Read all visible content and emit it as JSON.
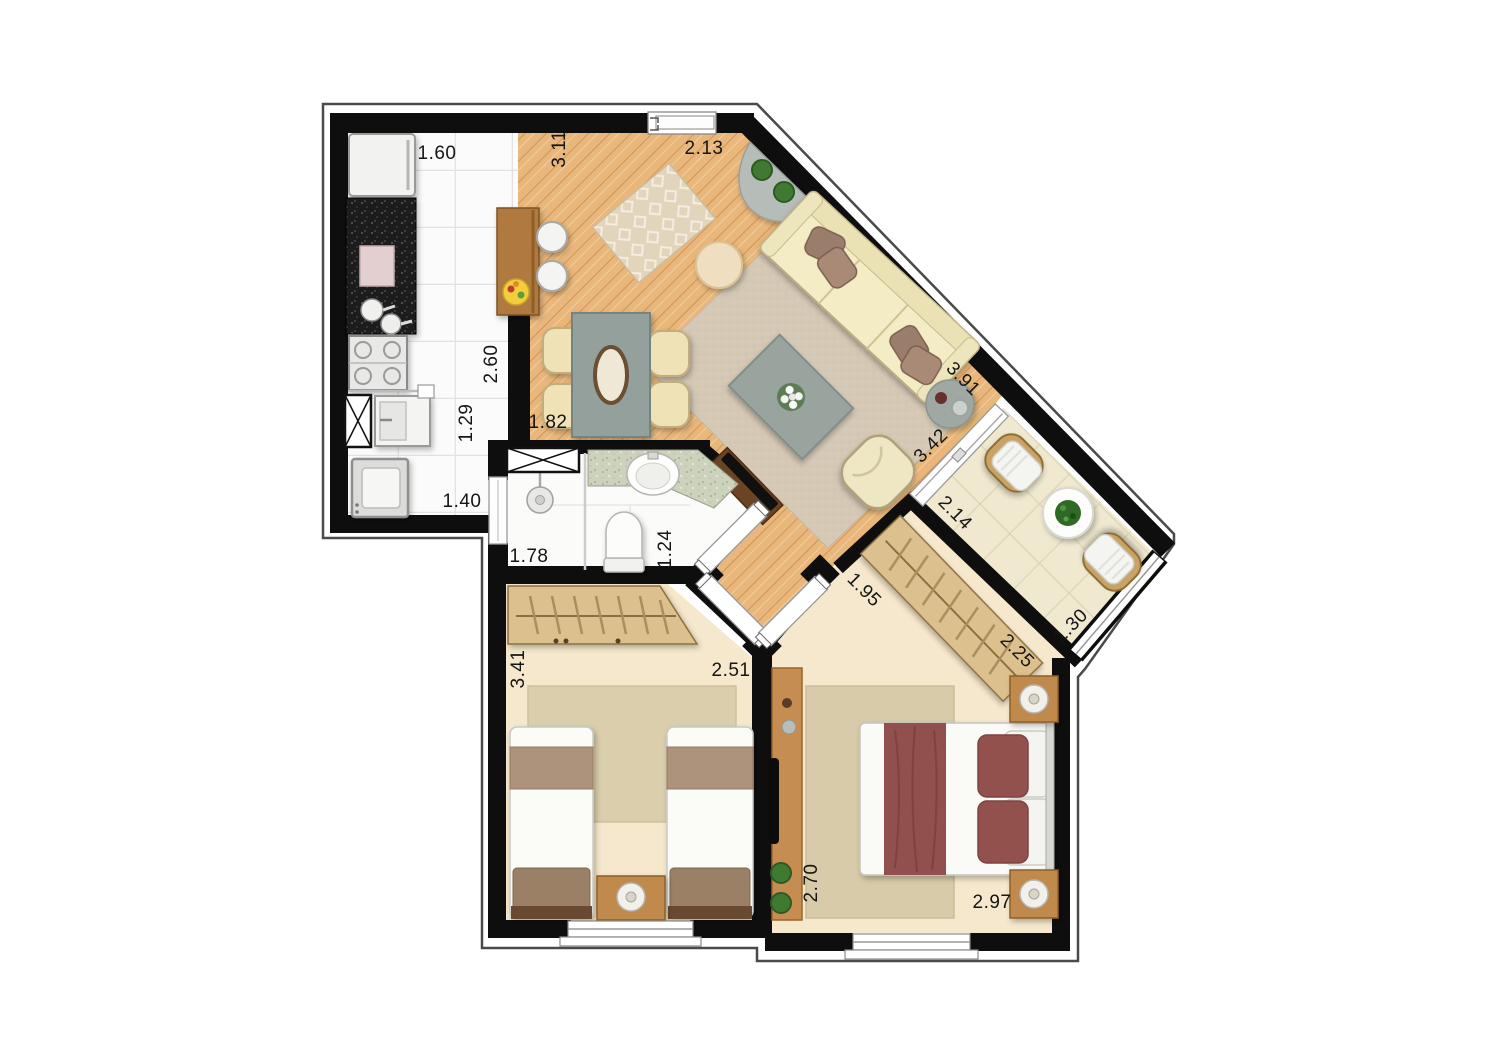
{
  "dimensions": {
    "kitchen_top": "1.60",
    "living_top_left": "3.11",
    "living_top_right": "2.13",
    "kitchen_right": "2.60",
    "laundry_right": "1.29",
    "dining_bottom": "1.82",
    "laundry_bottom": "1.40",
    "bathroom_shower": "1.78",
    "bathroom_side": "1.24",
    "sofa_wall": "3.91",
    "balcony_door": "3.42",
    "balcony_width": "2.14",
    "balcony_side": "1.30",
    "bedroom2_entry": "1.95",
    "bedroom2_wardrobe": "2.25",
    "bedroom1_side": "3.41",
    "bedroom1_top": "2.51",
    "bedroom2_side": "2.70",
    "bedroom2_bottom": "2.97"
  },
  "colors": {
    "wall": "#0e0e0e",
    "wood_floor": "#e9b77b",
    "tile_floor": "#fbfbfb",
    "bedroom_floor": "#f6e8cc",
    "balcony_floor": "#f0e9d0",
    "living_rug": "#d5c8b5",
    "bedroom_rug": "#dbcead",
    "sofa": "#f3ecc5",
    "pillow_brown": "#9b7d6c",
    "bed_accent": "#91504d",
    "wardrobe_wood": "#dcc18e",
    "furniture_wood": "#c08a4e",
    "granite": "#1f1f1f",
    "table_gray": "#93a09b"
  }
}
